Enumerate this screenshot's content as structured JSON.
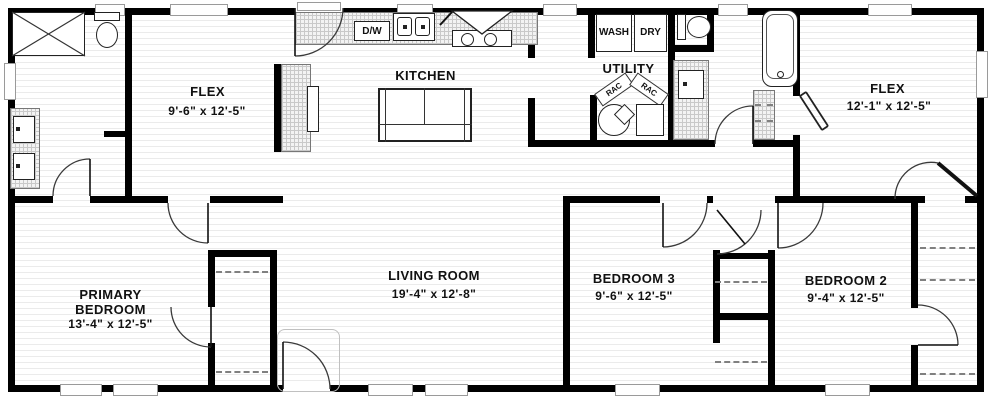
{
  "rooms": {
    "flex_left": {
      "name": "FLEX",
      "dims": "9'-6\" x 12'-5\""
    },
    "kitchen": {
      "name": "KITCHEN"
    },
    "utility": {
      "name": "UTILITY"
    },
    "flex_right": {
      "name": "FLEX",
      "dims": "12'-1\" x 12'-5\""
    },
    "primary_bedroom": {
      "name": "PRIMARY BEDROOM",
      "dims": "13'-4\" x 12'-5\""
    },
    "living_room": {
      "name": "LIVING ROOM",
      "dims": "19'-4\" x 12'-8\""
    },
    "bedroom_3": {
      "name": "BEDROOM 3",
      "dims": "9'-6\" x 12'-5\""
    },
    "bedroom_2": {
      "name": "BEDROOM 2",
      "dims": "9'-4\" x 12'-5\""
    }
  },
  "appliances": {
    "dishwasher": "D/W",
    "washer": "WASH",
    "dryer": "DRY",
    "rack": "RAC"
  },
  "colors": {
    "wall": "#000000",
    "floor_stripe": "#ebebeb",
    "hatch_border": "#777777",
    "text": "#111111"
  }
}
